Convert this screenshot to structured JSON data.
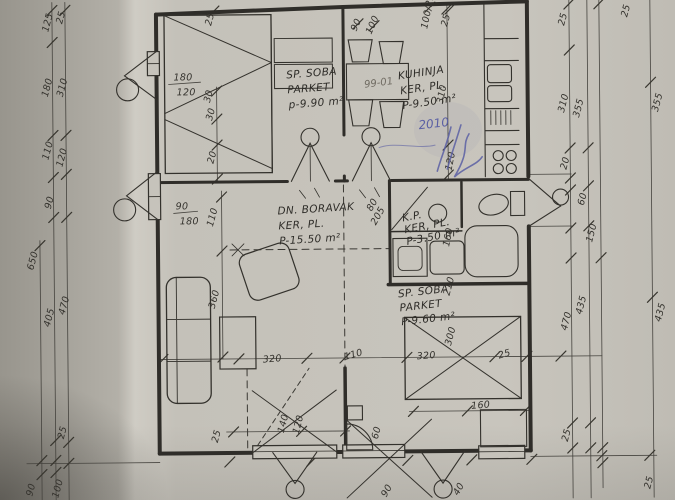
{
  "document": {
    "type": "scanned hand-drawn apartment floor plan",
    "ink_color": "#34322d",
    "paper_color": "#c6c3bb",
    "pen_color": "#5b60a4"
  },
  "room_labels": [
    {
      "name": "room-label-bedroom-1",
      "lines": [
        "SP. SOBA",
        "PARKET",
        "p-9.90 m²"
      ],
      "x": 288,
      "y": 78,
      "r": -4,
      "lh": 15
    },
    {
      "name": "room-label-kitchen",
      "lines": [
        "KUHINJA",
        "KER, PL.",
        "P-9.50 m²"
      ],
      "x": 400,
      "y": 80,
      "r": -8,
      "lh": 15
    },
    {
      "name": "room-label-living-room",
      "lines": [
        "DN. BORAVAK",
        "KER, PL.",
        "P-15.50 m²"
      ],
      "x": 278,
      "y": 214,
      "r": -3,
      "lh": 15
    },
    {
      "name": "room-label-bathroom",
      "lines": [
        "K.P.",
        "KER, PL.",
        "P-3.50 m²"
      ],
      "x": 403,
      "y": 222,
      "r": -10,
      "lh": 12,
      "fs": 8.5
    },
    {
      "name": "room-label-bedroom-2",
      "lines": [
        "SP. SOBA",
        "PARKET",
        "P-9.60 m²"
      ],
      "x": 398,
      "y": 298,
      "r": -6,
      "lh": 14,
      "fs": 10
    }
  ],
  "dim_labels": [
    {
      "t": "125",
      "x": 50,
      "y": 30,
      "r": -75
    },
    {
      "t": "25",
      "x": 64,
      "y": 22,
      "r": -75
    },
    {
      "t": "650",
      "x": 33,
      "y": 268,
      "r": -75
    },
    {
      "t": "180",
      "x": 49,
      "y": 95,
      "r": -75
    },
    {
      "t": "310",
      "x": 64,
      "y": 95,
      "r": -75
    },
    {
      "t": "110",
      "x": 49,
      "y": 158,
      "r": -75
    },
    {
      "t": "120",
      "x": 63,
      "y": 165,
      "r": -75
    },
    {
      "t": "90",
      "x": 51,
      "y": 207,
      "r": -75
    },
    {
      "t": "405",
      "x": 49,
      "y": 325,
      "r": -75
    },
    {
      "t": "470",
      "x": 64,
      "y": 313,
      "r": -75
    },
    {
      "t": "25",
      "x": 62,
      "y": 437,
      "r": -75
    },
    {
      "t": "90",
      "x": 30,
      "y": 494,
      "r": -75
    },
    {
      "t": "100",
      "x": 56,
      "y": 496,
      "r": -75
    },
    {
      "t": "25",
      "x": 566,
      "y": 28,
      "r": -75
    },
    {
      "t": "25",
      "x": 629,
      "y": 20,
      "r": -75
    },
    {
      "t": "310",
      "x": 565,
      "y": 115,
      "r": -75
    },
    {
      "t": "355",
      "x": 580,
      "y": 120,
      "r": -75
    },
    {
      "t": "355",
      "x": 659,
      "y": 115,
      "r": -75
    },
    {
      "t": "20",
      "x": 567,
      "y": 172,
      "r": -75
    },
    {
      "t": "60",
      "x": 584,
      "y": 208,
      "r": -75
    },
    {
      "t": "150",
      "x": 592,
      "y": 245,
      "r": -75
    },
    {
      "t": "470",
      "x": 566,
      "y": 333,
      "r": -75
    },
    {
      "t": "435",
      "x": 581,
      "y": 317,
      "r": -75
    },
    {
      "t": "435",
      "x": 660,
      "y": 325,
      "r": -75
    },
    {
      "t": "25",
      "x": 566,
      "y": 444,
      "r": -75
    },
    {
      "t": "25",
      "x": 648,
      "y": 492,
      "r": -75
    },
    {
      "t": "25",
      "x": 213,
      "y": 25,
      "r": -75
    },
    {
      "t": "90",
      "x": 358,
      "y": 32,
      "r": -65
    },
    {
      "t": "100",
      "x": 373,
      "y": 35,
      "r": -65
    },
    {
      "t": "100/210",
      "x": 429,
      "y": 30,
      "r": -78
    },
    {
      "t": "25",
      "x": 449,
      "y": 28,
      "r": -75
    },
    {
      "t": "180",
      "x": 175,
      "y": 79,
      "r": 0
    },
    {
      "t": "120",
      "x": 178,
      "y": 94,
      "r": 0
    },
    {
      "t": "30",
      "x": 211,
      "y": 102,
      "r": -75
    },
    {
      "t": "30",
      "x": 213,
      "y": 120,
      "r": -75
    },
    {
      "t": "20",
      "x": 214,
      "y": 163,
      "r": -75
    },
    {
      "t": "310",
      "x": 444,
      "y": 105,
      "r": -78
    },
    {
      "t": "120",
      "x": 452,
      "y": 172,
      "r": -78
    },
    {
      "t": "90",
      "x": 176,
      "y": 208,
      "r": 0
    },
    {
      "t": "180",
      "x": 180,
      "y": 223,
      "r": 0
    },
    {
      "t": "110",
      "x": 213,
      "y": 226,
      "r": -75
    },
    {
      "t": "360",
      "x": 214,
      "y": 308,
      "r": -75
    },
    {
      "t": "320",
      "x": 262,
      "y": 362,
      "r": -4
    },
    {
      "t": "110",
      "x": 344,
      "y": 360,
      "r": -15
    },
    {
      "t": "320",
      "x": 416,
      "y": 360,
      "r": -4
    },
    {
      "t": "300",
      "x": 450,
      "y": 347,
      "r": -75
    },
    {
      "t": "210",
      "x": 449,
      "y": 297,
      "r": -75
    },
    {
      "t": "25",
      "x": 498,
      "y": 360,
      "r": -15
    },
    {
      "t": "160",
      "x": 449,
      "y": 248,
      "r": -78
    },
    {
      "t": "80",
      "x": 372,
      "y": 212,
      "r": -60,
      "fs": 8
    },
    {
      "t": "205",
      "x": 376,
      "y": 226,
      "r": -60,
      "fs": 8
    },
    {
      "t": "160",
      "x": 470,
      "y": 410,
      "r": -4
    },
    {
      "t": "60",
      "x": 376,
      "y": 440,
      "r": -75
    },
    {
      "t": "25",
      "x": 216,
      "y": 442,
      "r": -75
    },
    {
      "t": "140",
      "x": 282,
      "y": 433,
      "r": -75
    },
    {
      "t": "120",
      "x": 297,
      "y": 434,
      "r": -75
    },
    {
      "t": "90",
      "x": 384,
      "y": 498,
      "r": -60
    },
    {
      "t": "40",
      "x": 456,
      "y": 497,
      "r": -60
    }
  ],
  "annotations": [
    {
      "t": "99-01",
      "x": 366,
      "y": 88,
      "r": -7,
      "cls": "pencil",
      "name": "pencil-note"
    },
    {
      "t": "2010",
      "x": 420,
      "y": 130,
      "r": -6,
      "cls": "pen",
      "name": "pen-year-note"
    }
  ]
}
